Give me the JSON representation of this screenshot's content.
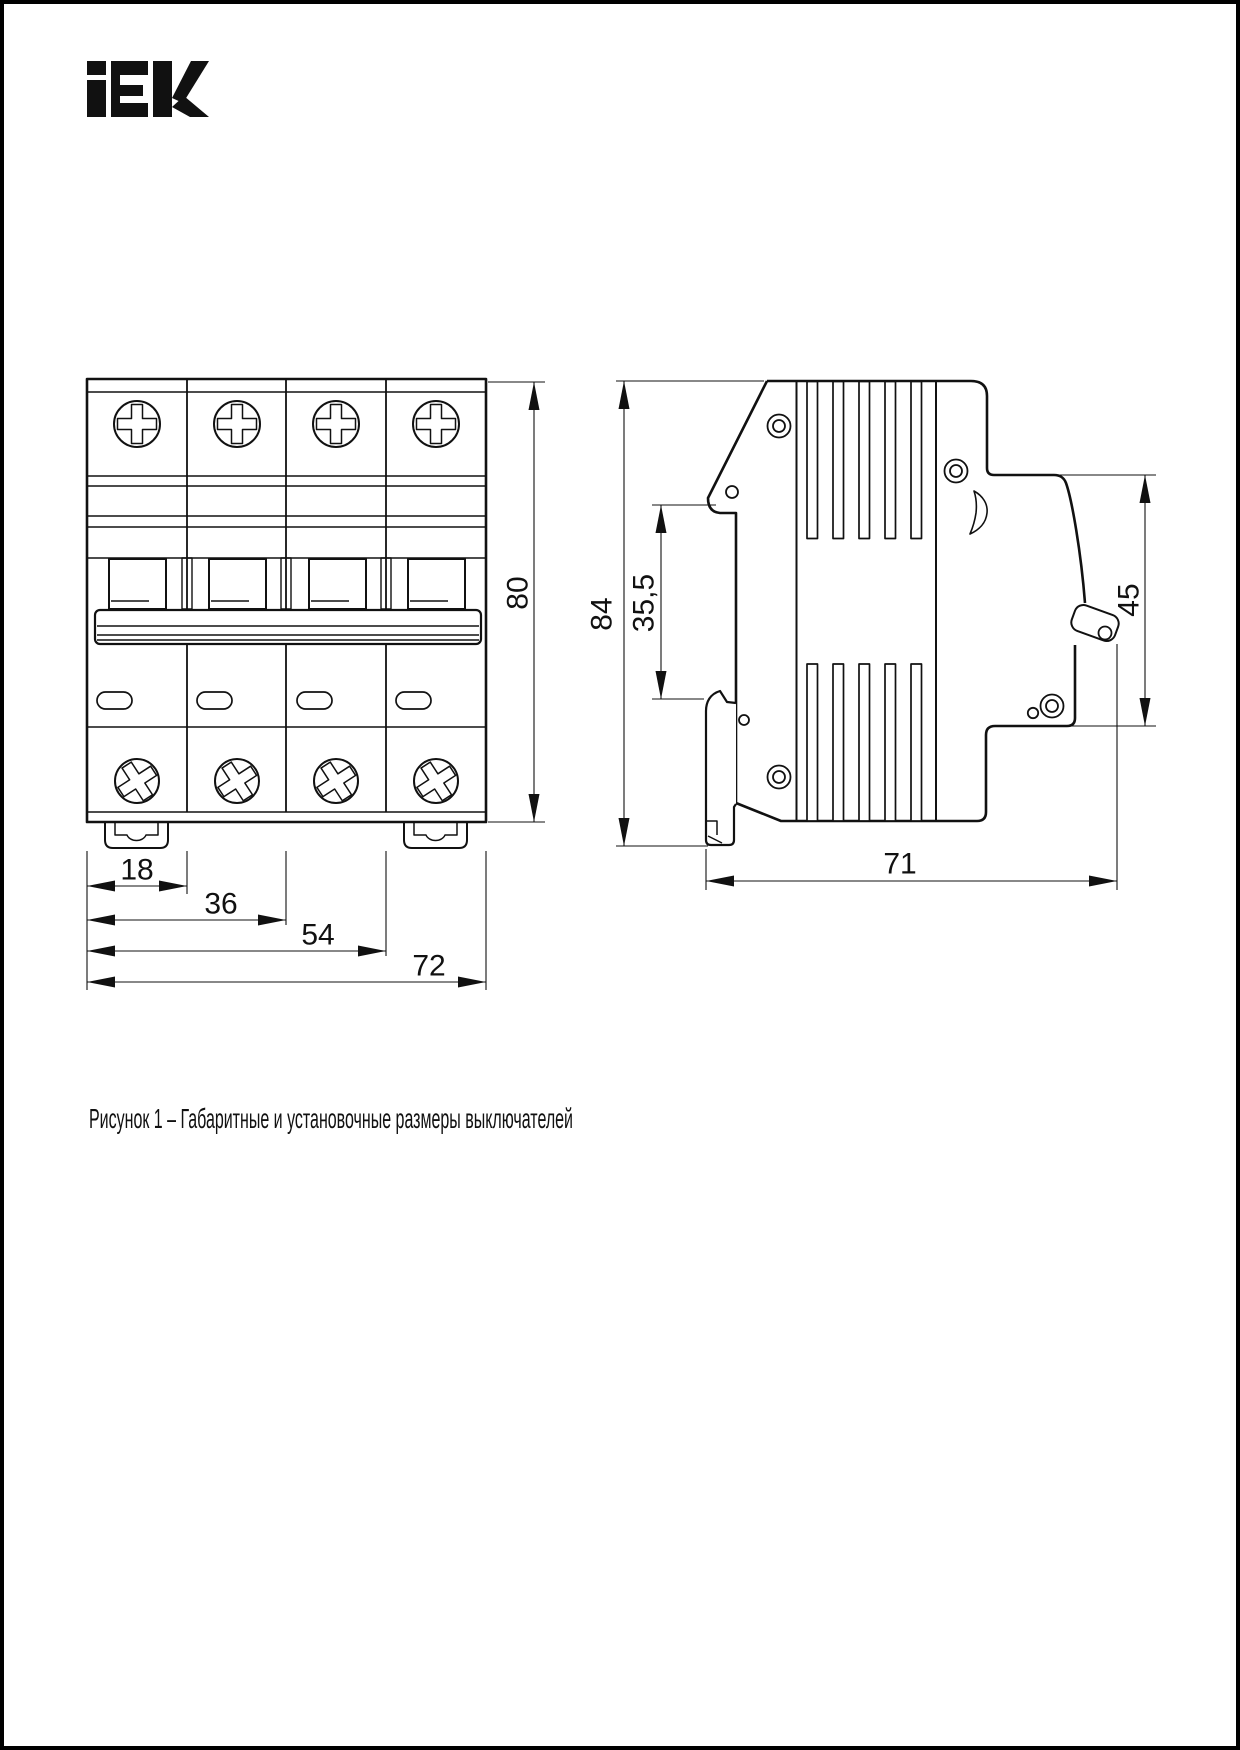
{
  "colors": {
    "ink": "#111111",
    "paper": "#ffffff",
    "border": "#000000"
  },
  "logo": {
    "icon": "iek-logo",
    "brand": "IEK"
  },
  "figure": {
    "caption": "Рисунок 1 – Габаритные и установочные размеры выключателей"
  },
  "front_view": {
    "label": "front-view",
    "dim_height": "80",
    "dim_widths": [
      "18",
      "36",
      "54",
      "72"
    ]
  },
  "side_view": {
    "label": "side-view",
    "dim_height": "84",
    "dim_handle_depth": "35,5",
    "dim_upper_depth": "45",
    "dim_depth": "71"
  }
}
